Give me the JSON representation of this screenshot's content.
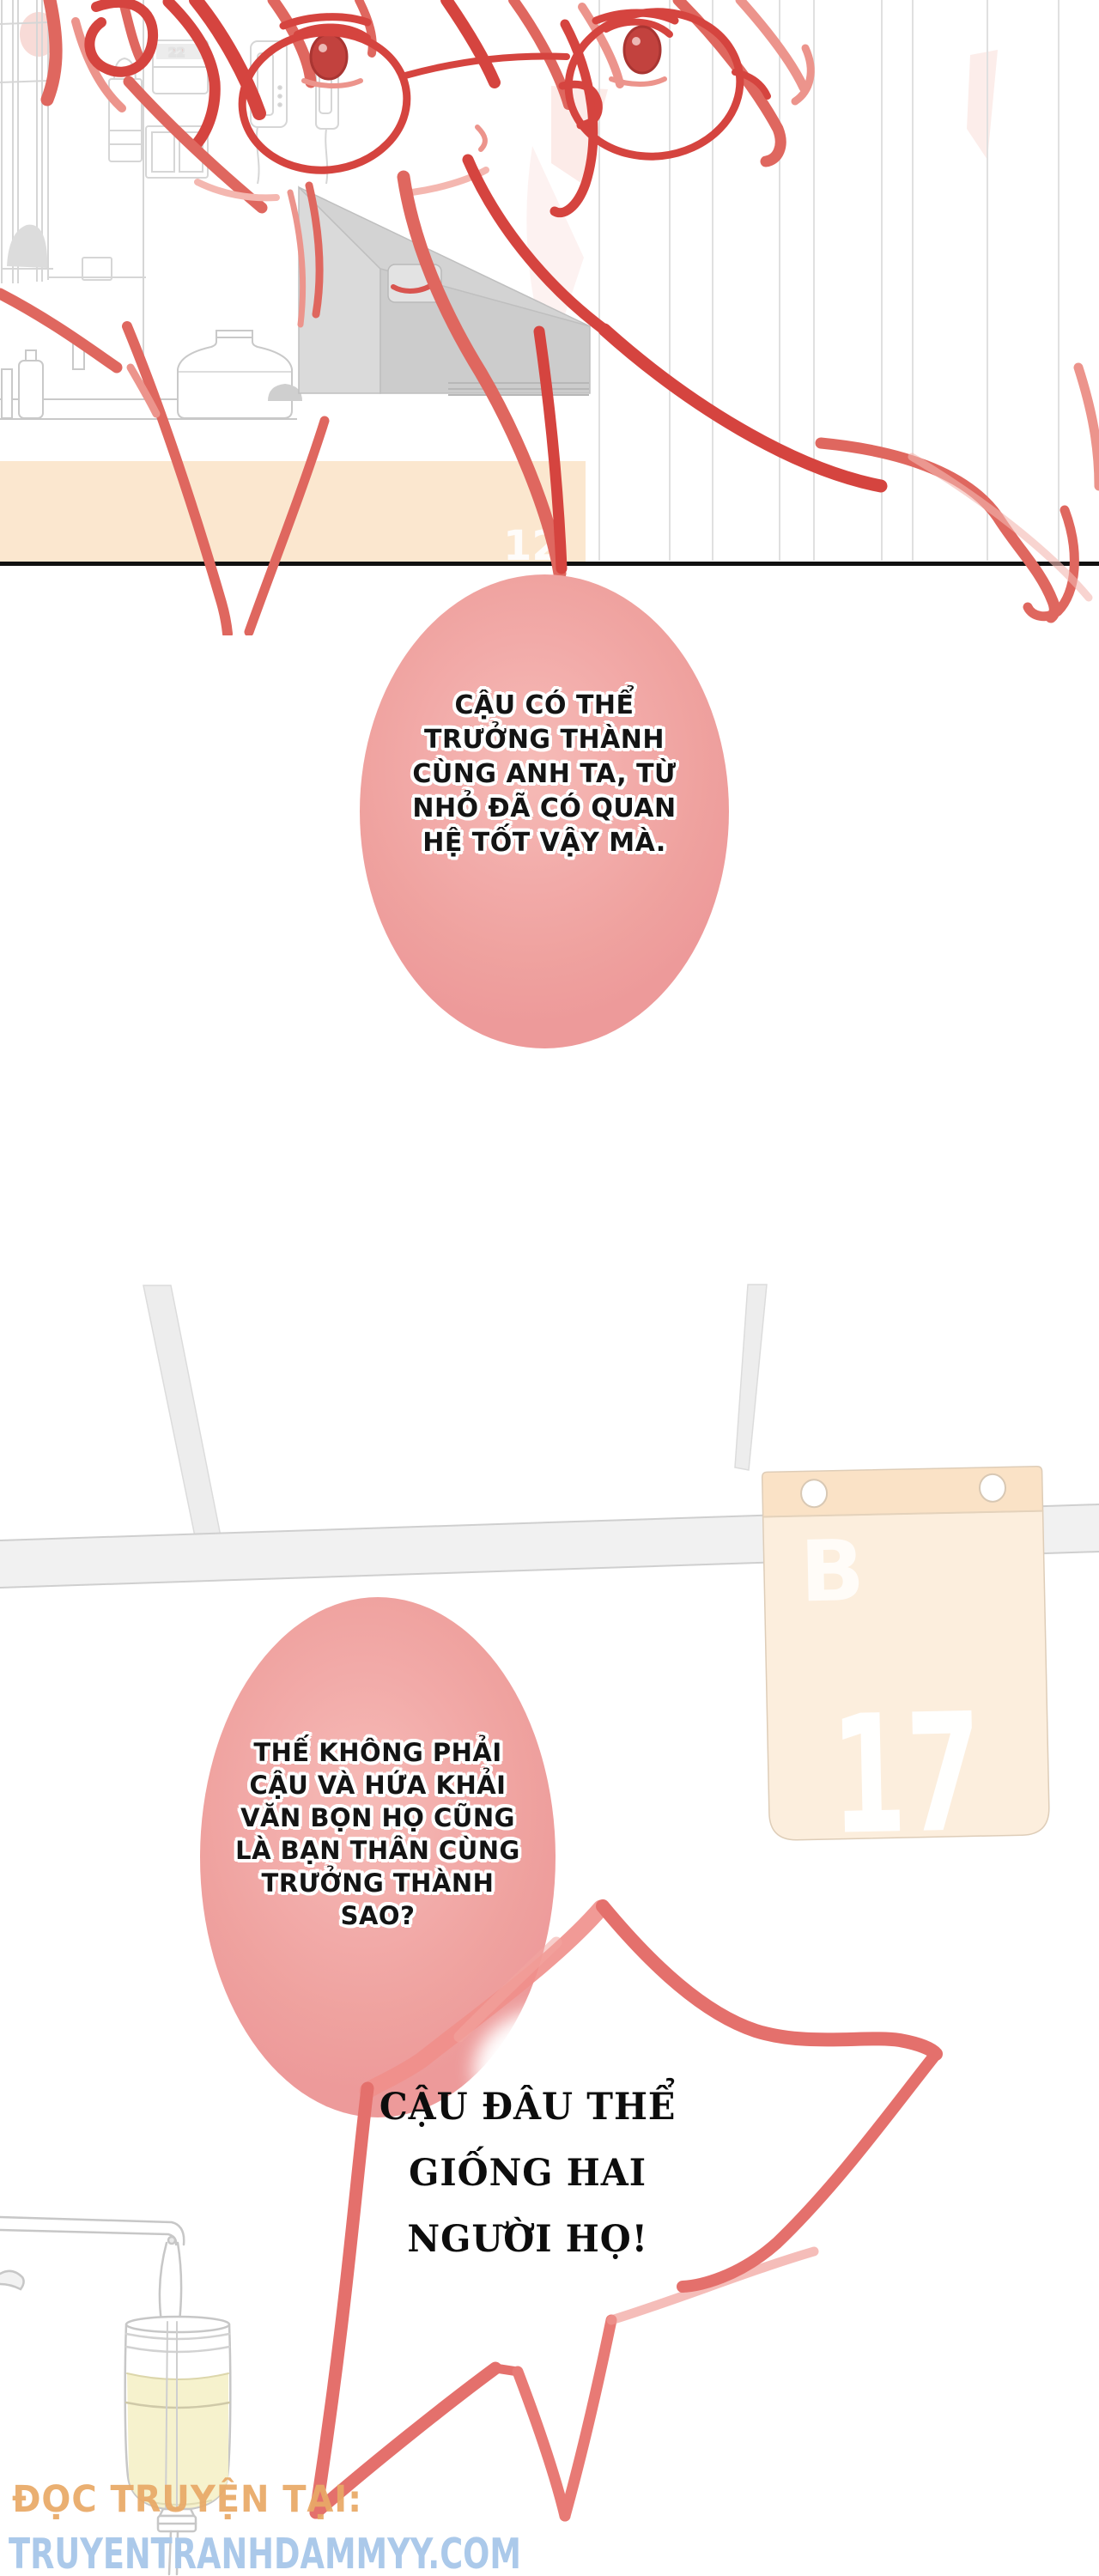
{
  "page": {
    "type": "vietnamese-manga-page",
    "background": "#ffffff"
  },
  "panel1": {
    "description": "rough red sketch of a bespectacled character in a room with a TV",
    "faint_band_text": "12",
    "border_color": "#111111",
    "table_color": "#fbe7cf"
  },
  "bubbles": [
    {
      "shape": "oval",
      "fill": "#efa2a0",
      "lines": [
        "CẬU CÓ THỂ",
        "TRƯỞNG THÀNH",
        "CÙNG ANH TA, TỪ",
        "NHỎ ĐÃ CÓ QUAN",
        "HỆ TỐT VẬY MÀ."
      ]
    },
    {
      "shape": "oval",
      "fill": "#efa2a0",
      "lines": [
        "THẾ KHÔNG PHẢI",
        "CẬU VÀ HỨA KHẢI",
        "VĂN BỌN HỌ CŨNG",
        "LÀ BẠN THÂN CÙNG",
        "TRƯỞNG THÀNH",
        "SAO?"
      ]
    }
  ],
  "star_bubble": {
    "shape": "jagged-star-outline",
    "stroke": "#e4706c",
    "lines": [
      "CẬU ĐÂU THỂ",
      "GIỐNG HAI",
      "NGƯỜI HỌ!"
    ]
  },
  "calendar": {
    "letter": "B",
    "number": "17",
    "body_color": "#fceedd",
    "band_color": "#fae2c6"
  },
  "watermark": {
    "line1": "ĐỌC TRUYỆN TẠI:",
    "line2": "TRUYENTRANHDAMMYY.COM",
    "line1_color": "#e9a967",
    "line2_color": "#abc9ea"
  },
  "colors": {
    "sketch_dark": "#d5443f",
    "sketch_mid": "#df675f",
    "sketch_light": "#ec948c",
    "beam_gray": "#ededed",
    "bubble_pink": "#efa2a0"
  }
}
